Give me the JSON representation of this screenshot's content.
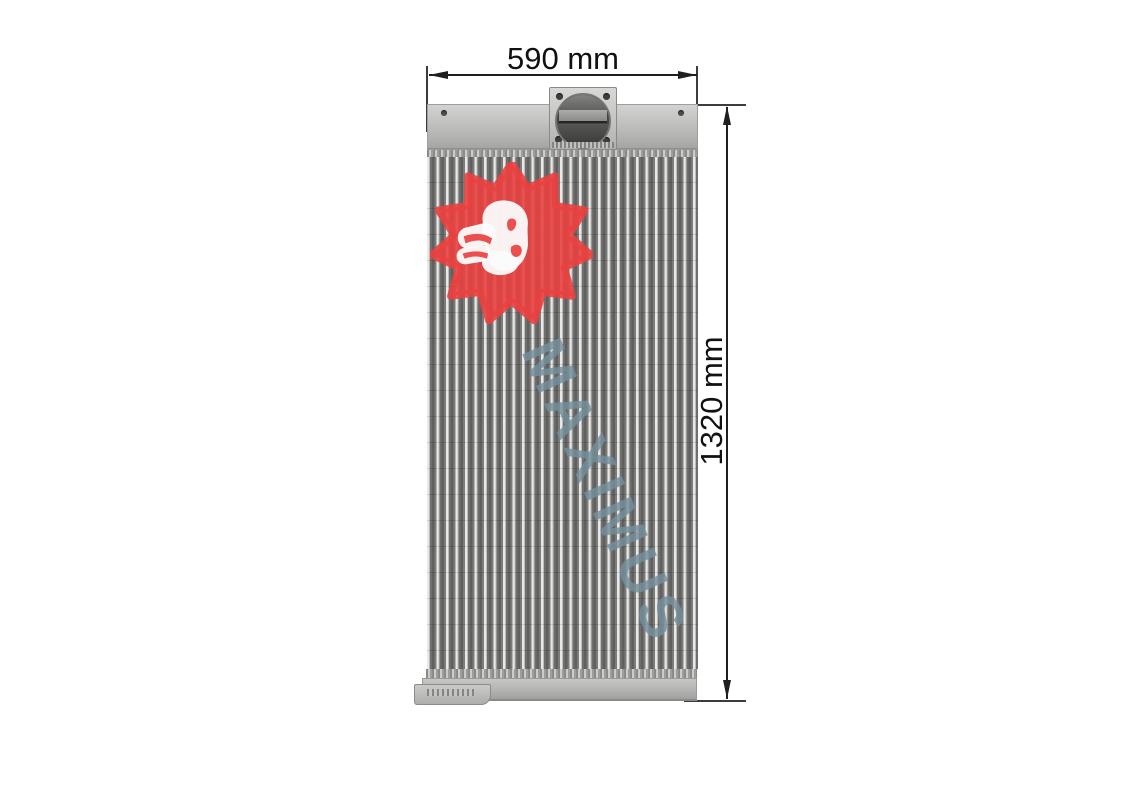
{
  "canvas": {
    "width_px": 1123,
    "height_px": 794,
    "background": "#ffffff"
  },
  "annotations": {
    "width_dimension": {
      "label": "590 mm"
    },
    "height_dimension": {
      "label": "1320 mm"
    },
    "line_color": "#1f1f1f",
    "text_color": "#111111"
  },
  "watermark": {
    "text": "MAXIMUS",
    "text_color": "#74909e",
    "logo_icon": "lion-head-spiky-mane-icon",
    "logo_red": "#e94140",
    "logo_face_color": "#fbfbfb"
  },
  "photo": {
    "subject": "aluminum radiator charge-air-cooler, front view with top inlet flange",
    "metal_light": "#d2d2d0",
    "metal_mid": "#b2b2b0",
    "metal_dark": "#8e8e8c",
    "core_tube_light": "#e8e8e6",
    "core_fin_dark": "#606060"
  }
}
